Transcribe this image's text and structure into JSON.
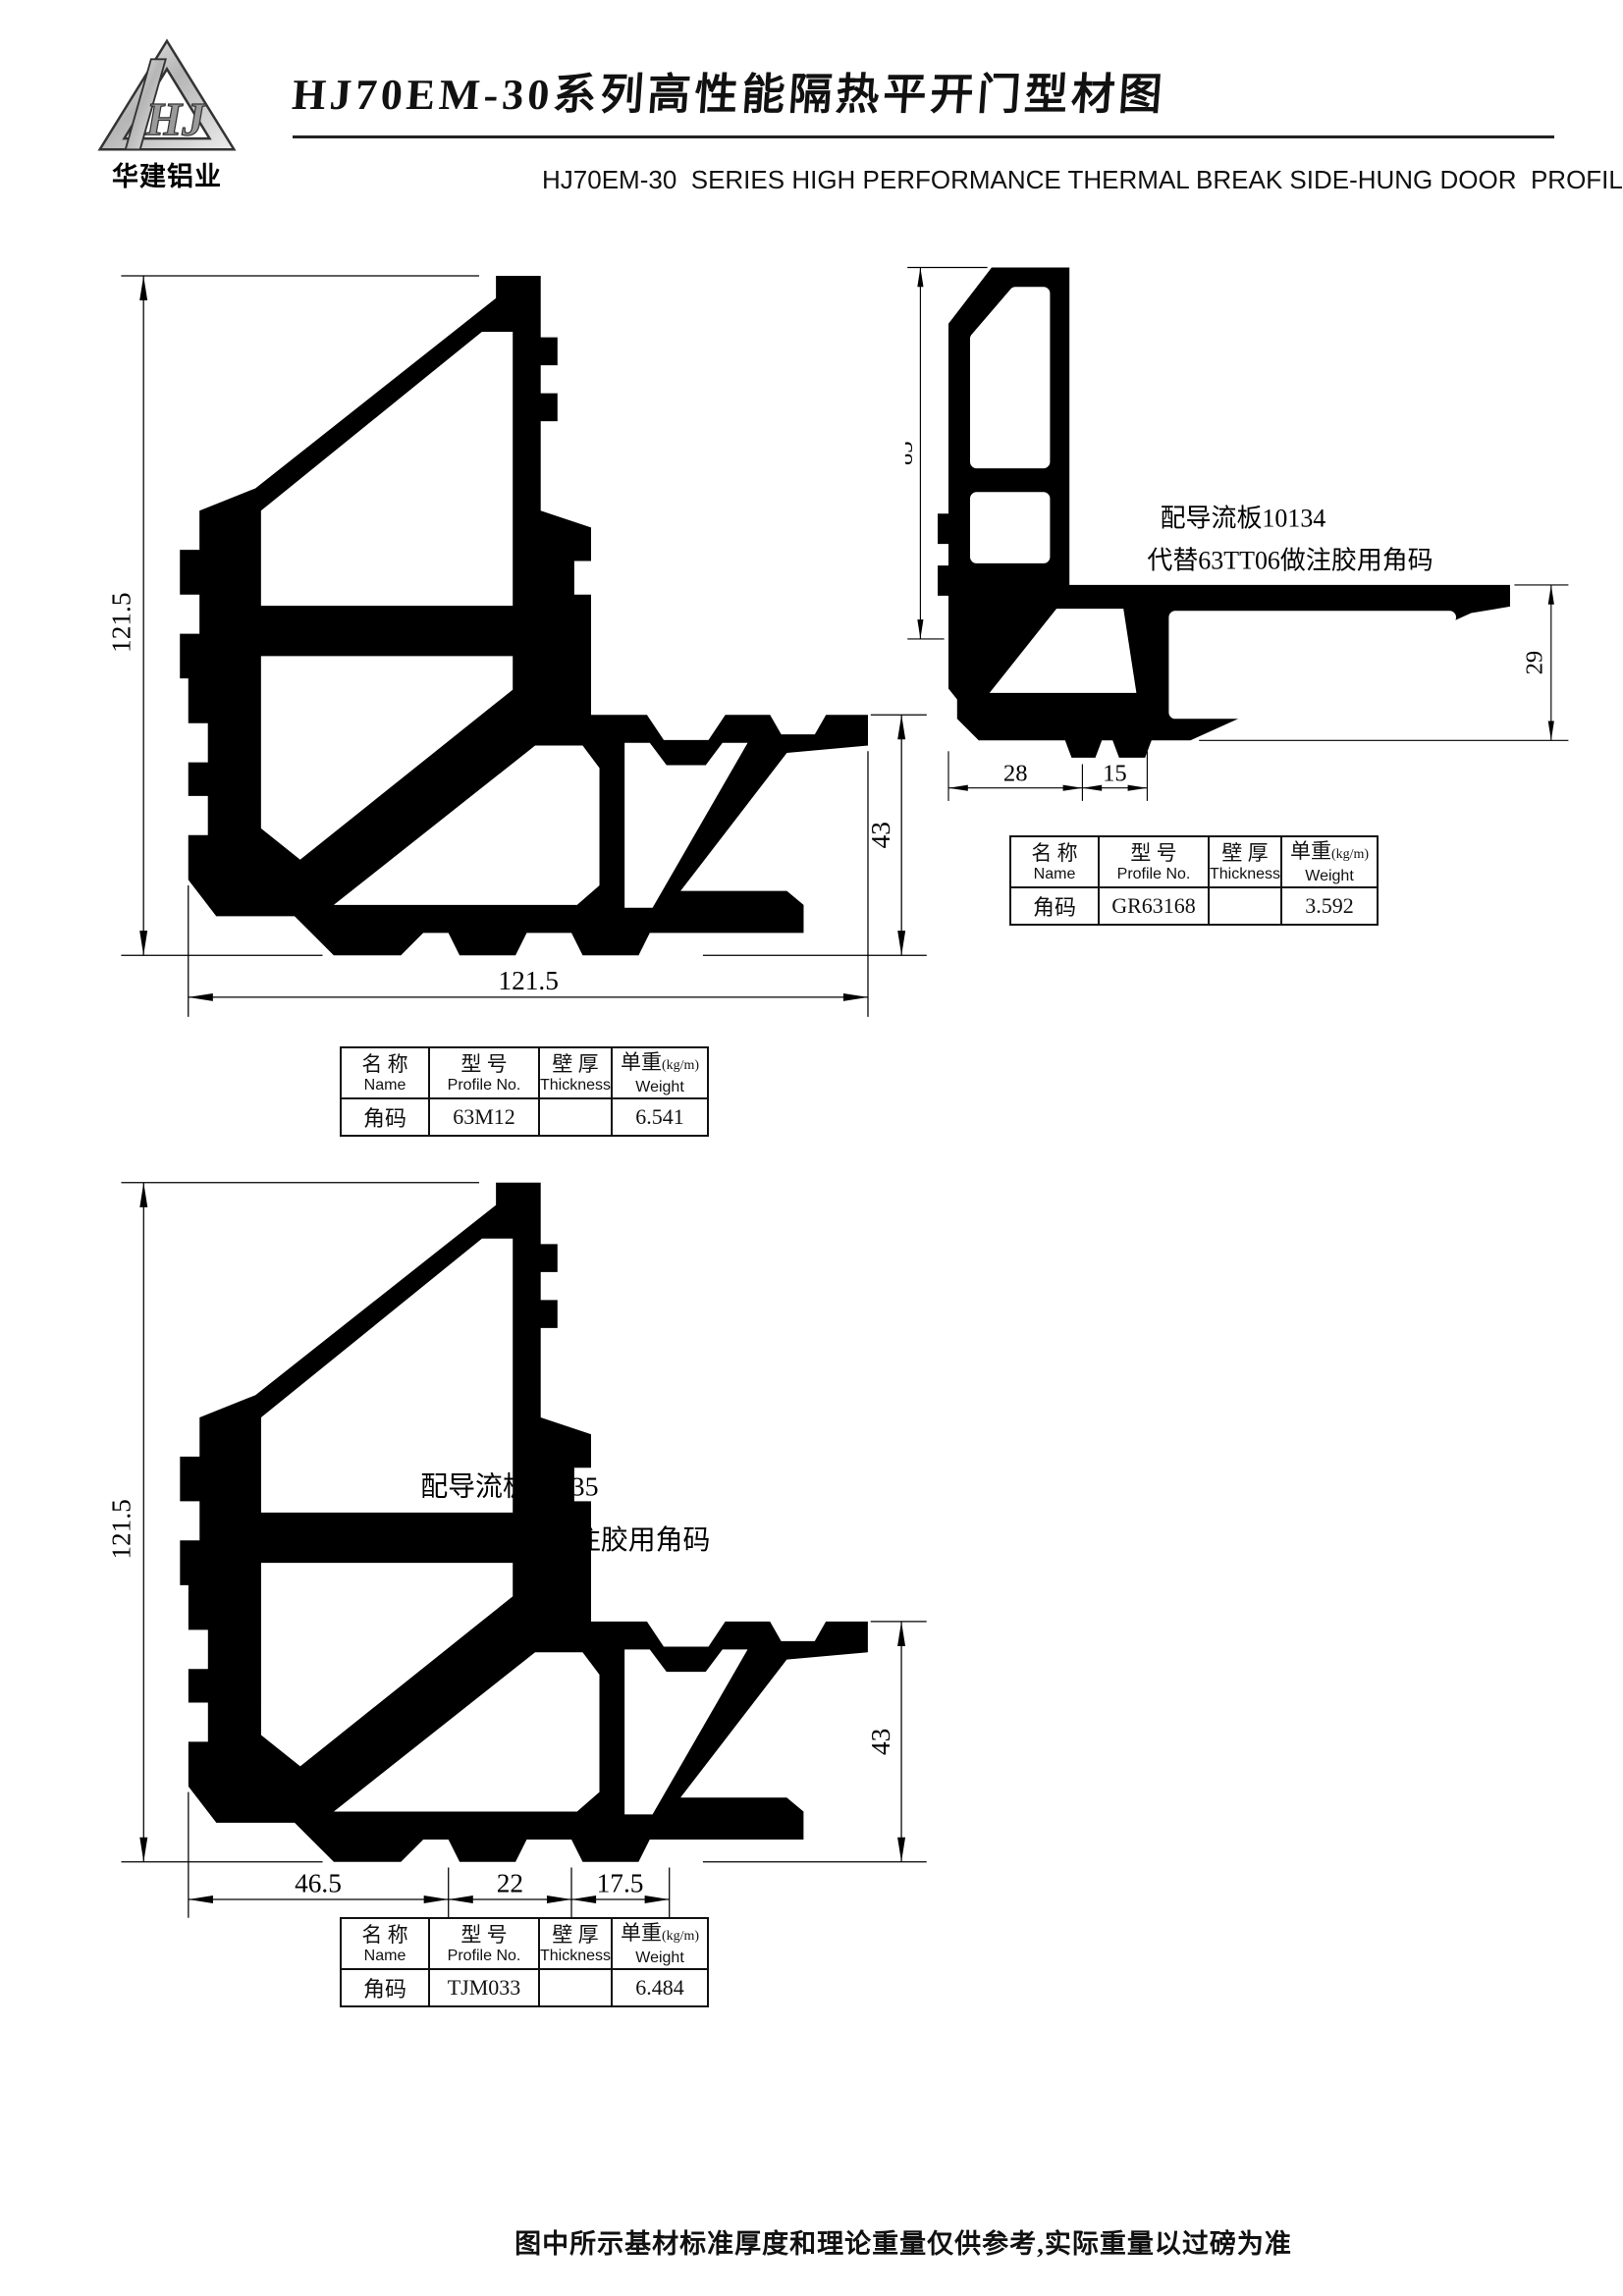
{
  "header": {
    "logo_text": "华建铝业",
    "title_cn": "HJ70EM-30系列高性能隔热平开门型材图",
    "title_en": "HJ70EM-30  SERIES HIGH PERFORMANCE THERMAL BREAK SIDE-HUNG DOOR  PROFILES"
  },
  "table_headers": {
    "name_cn": "名 称",
    "name_en": "Name",
    "model_cn": "型 号",
    "model_en": "Profile No.",
    "thickness_cn": "壁 厚",
    "thickness_en": "Thickness",
    "weight_cn": "单重",
    "weight_unit": "(kg/m)",
    "weight_en": "Weight"
  },
  "drawing1": {
    "dim_left": "121.5",
    "dim_bottom": "121.5",
    "dim_right": "43",
    "table": {
      "name": "角码",
      "profile_no": "63M12",
      "thickness": "",
      "weight": "6.541"
    }
  },
  "drawing2": {
    "annotation_line1": "配导流板10134",
    "annotation_line2": "代替63TT06做注胶用角码",
    "dim_left": "85",
    "dim_bottom1": "28",
    "dim_bottom2": "15",
    "dim_right": "29",
    "table": {
      "name": "角码",
      "profile_no": "GR63168",
      "thickness": "",
      "weight": "3.592"
    }
  },
  "drawing3": {
    "annotation_line1": "配导流板10135",
    "annotation_line2": "代替63M12做注胶用角码",
    "dim_left": "121.5",
    "dim_bottom1": "46.5",
    "dim_bottom2": "22",
    "dim_bottom3": "17.5",
    "dim_right": "43",
    "table": {
      "name": "角码",
      "profile_no": "TJM033",
      "thickness": "",
      "weight": "6.484"
    }
  },
  "footer": {
    "note": "图中所示基材标准厚度和理论重量仅供参考,实际重量以过磅为准"
  }
}
